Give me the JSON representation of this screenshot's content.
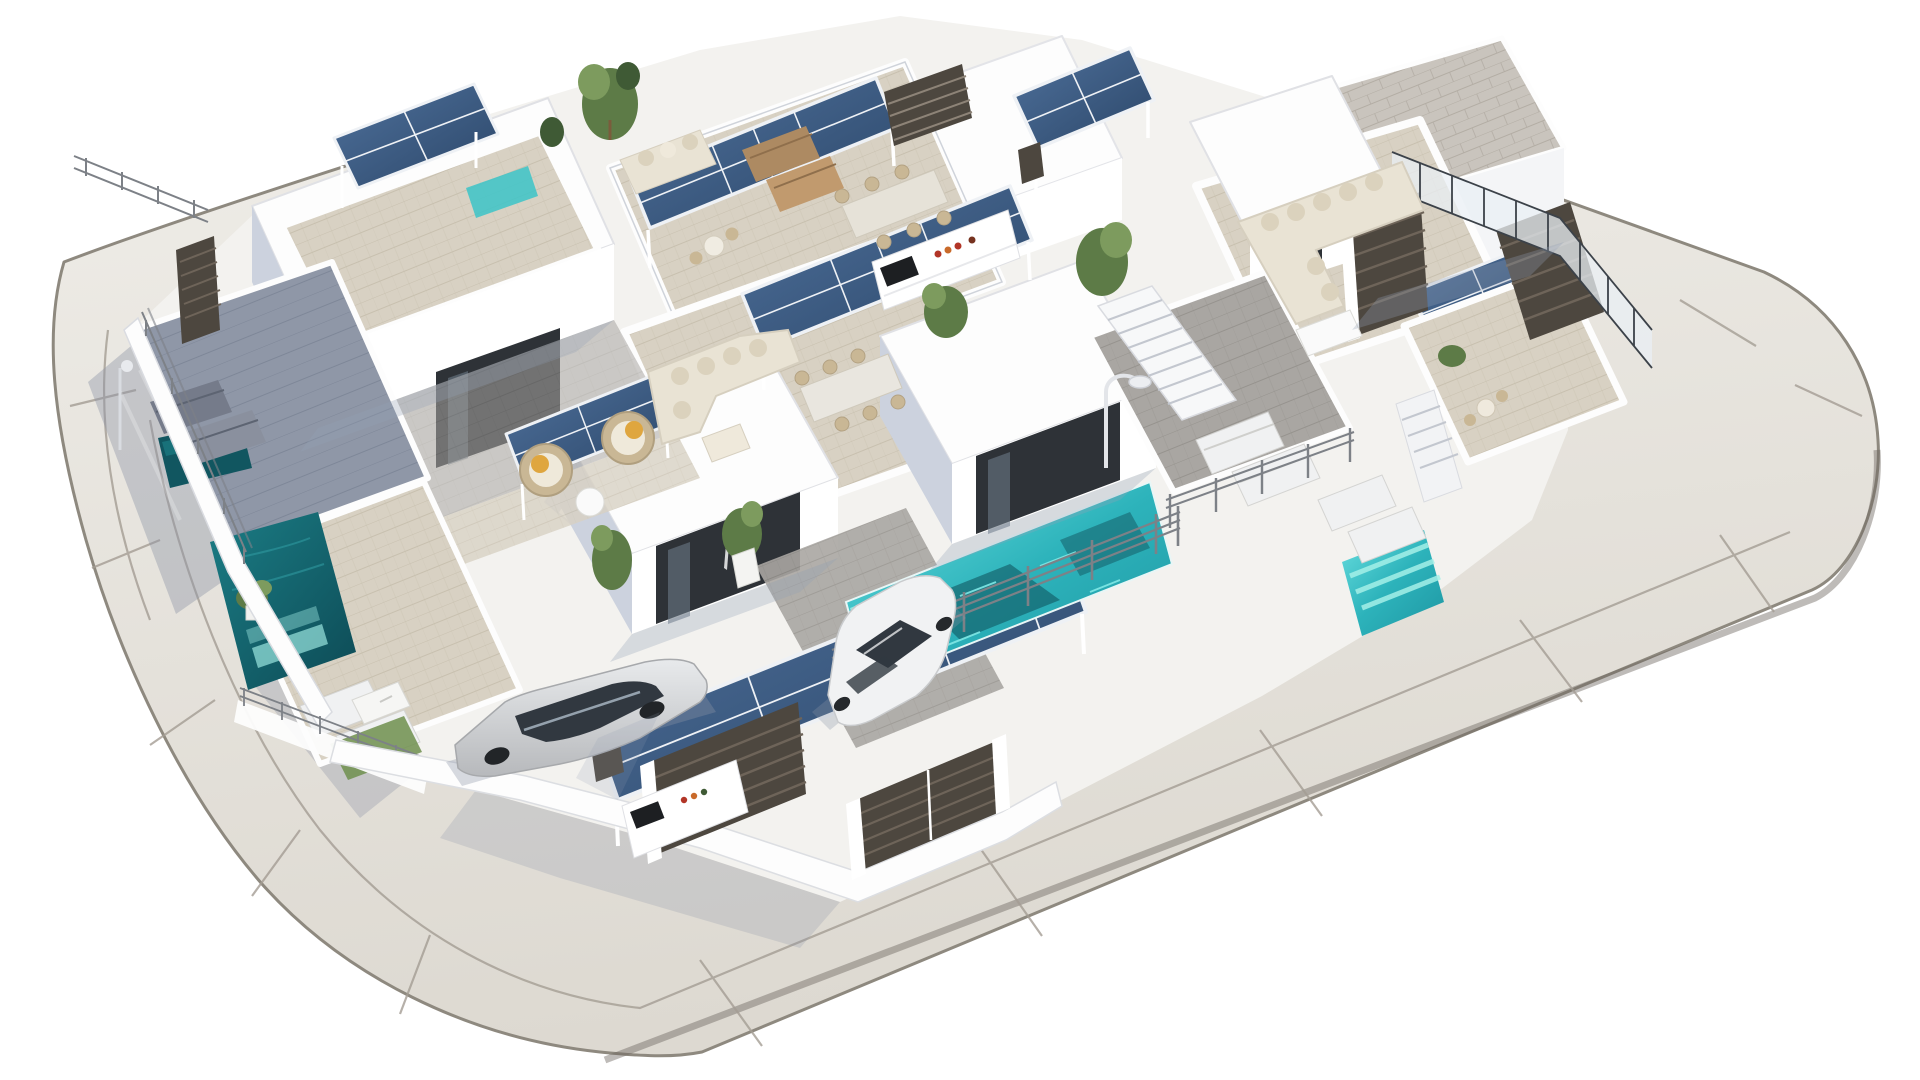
{
  "meta": {
    "domain": "Natural-Image",
    "description": "Aerial 3D architectural rendering of a modern white villa development with rooftop terraces, solar-panel pergolas, plunge pools, outdoor furniture, two parked cars and a surrounding rounded-rectangle road, on a plain white background."
  },
  "palette": {
    "background": "#ffffff",
    "road": "#e9e6e0",
    "road_light": "#efede8",
    "road_seam": "#a49d94",
    "curb": "#8e897f",
    "curb_dark": "#6e6962",
    "plot_base": "#f3f2ef",
    "wall_white": "#fdfdfd",
    "wall_bright": "#ffffff",
    "wall_shade": "#ccd2de",
    "wall_shade_deep": "#aab3c4",
    "parapet_edge": "#cfd3da",
    "tile_beige": "#d8d1c3",
    "tile_grout": "#c8c0af",
    "tile_gray": "#a9a6a2",
    "tile_gray_grout": "#96938e",
    "tile_shadow": "#8c94a6",
    "roof_gray": "#c9c4bd",
    "roof_gray_line": "#b3ada4",
    "solar_blue": "#31507a",
    "solar_blue_light": "#4f719c",
    "solar_frame": "#eef1f5",
    "pool_teal_dark": "#115660",
    "pool_teal": "#1b7d85",
    "pool_turquoise": "#3cc4c8",
    "pool_turquoise_light": "#7fe8e6",
    "pool_step": "#a5f0e8",
    "glass_dark": "#2e3237",
    "glass_streak": "#6b7885",
    "fence_dark": "#4d473f",
    "fence_slat": "#6e6459",
    "metal_gray": "#7d8187",
    "green_dark": "#3f5a35",
    "green": "#5d7b47",
    "green_light": "#7d9b5e",
    "sofa_beige": "#e9e3d4",
    "cushion_beige": "#dbd2bd",
    "cushion_yellow": "#dfa63f",
    "wood_brown": "#ad8a62",
    "rattan": "#c9b795",
    "car_silver": "#c7c9cb",
    "car_white": "#f1f2f3",
    "car_glass": "#313840",
    "shadow_blue": "#93a0b4",
    "lawn_green": "#6f8f4e"
  },
  "scene": {
    "background": "plain white studio backdrop",
    "camera": "high aerial three-quarter view",
    "lighting": "sun from the upper right, soft blue-grey shadows cast to the lower left",
    "road": {
      "shape": "rounded rectangular perimeter road (stadium shape) in perspective",
      "surface": "light warm-grey concrete slabs with expansion-joint seams and darker curb edge"
    },
    "development": {
      "white_flat_roof_villas": 8,
      "two_storey_corner_house": 1,
      "solar_pergolas": 7,
      "pools": [
        {
          "id": "left-upper",
          "water": "dark teal, in building shadow"
        },
        {
          "id": "left-lower",
          "water": "dark teal with lighter entry steps"
        },
        {
          "id": "central",
          "water": "bright turquoise behind a steel railing"
        },
        {
          "id": "right",
          "water": "turquoise with stepped entry"
        }
      ],
      "cars": [
        {
          "id": "silver-car",
          "color": "silver",
          "location": "lower-left driveway behind slatted gate"
        },
        {
          "id": "white-car",
          "color": "white",
          "location": "central driveway with dark glass roof"
        }
      ],
      "fences": "dark brown horizontal-slat gates and panels with white pillars",
      "railings": "thin steel rails and framed glass balustrades",
      "furniture": [
        "beige corner sofas with cushions",
        "outdoor dining sets with wicker chairs",
        "rattan egg chairs with yellow cushions",
        "white and brown sun loungers",
        "outdoor kitchens with shelving and black grills",
        "potted plants and small trees"
      ]
    }
  }
}
